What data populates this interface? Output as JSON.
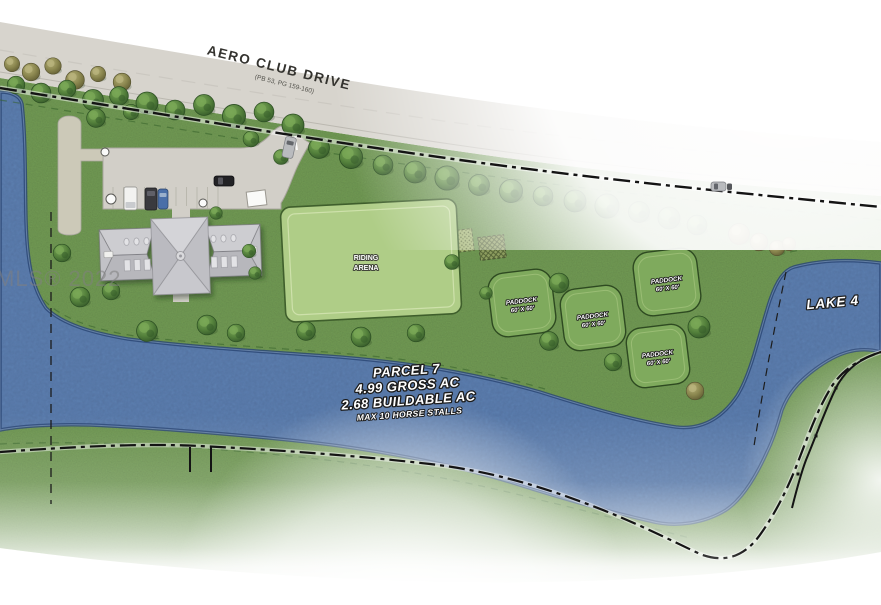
{
  "plan": {
    "road_name": "AERO CLUB DRIVE",
    "road_plat": "(PB 53, PG 159-160)",
    "watermark": "MLS® 2022",
    "lake_label": "LAKE 4",
    "arena": {
      "line1": "RIDING",
      "line2": "ARENA"
    },
    "parcel": {
      "title": "PARCEL 7",
      "gross": "4.99 GROSS AC",
      "buildable": "2.68 BUILDABLE AC",
      "stalls": "MAX 10 HORSE STALLS"
    },
    "paddocks": [
      {
        "label": "PADDOCK",
        "size": "60' X 60'"
      },
      {
        "label": "PADDOCK",
        "size": "60' X 60'"
      },
      {
        "label": "PADDOCK",
        "size": "60' X 60'"
      },
      {
        "label": "PADDOCK",
        "size": "60' X 60'"
      }
    ],
    "colors": {
      "grass": "#76a156",
      "water": "#5f84b6",
      "water_edge": "#2b4876",
      "road": "#d7d4cd",
      "arena_green": "#afcd87",
      "paddock_green": "#7faa5d",
      "roof_gray": "#c7c7cb",
      "boundary": "#141414",
      "tree_green": "#3e6b30",
      "tree_olive": "#8b874f",
      "label_fill": "#ffffff",
      "label_outline": "#1c1c1c"
    }
  }
}
